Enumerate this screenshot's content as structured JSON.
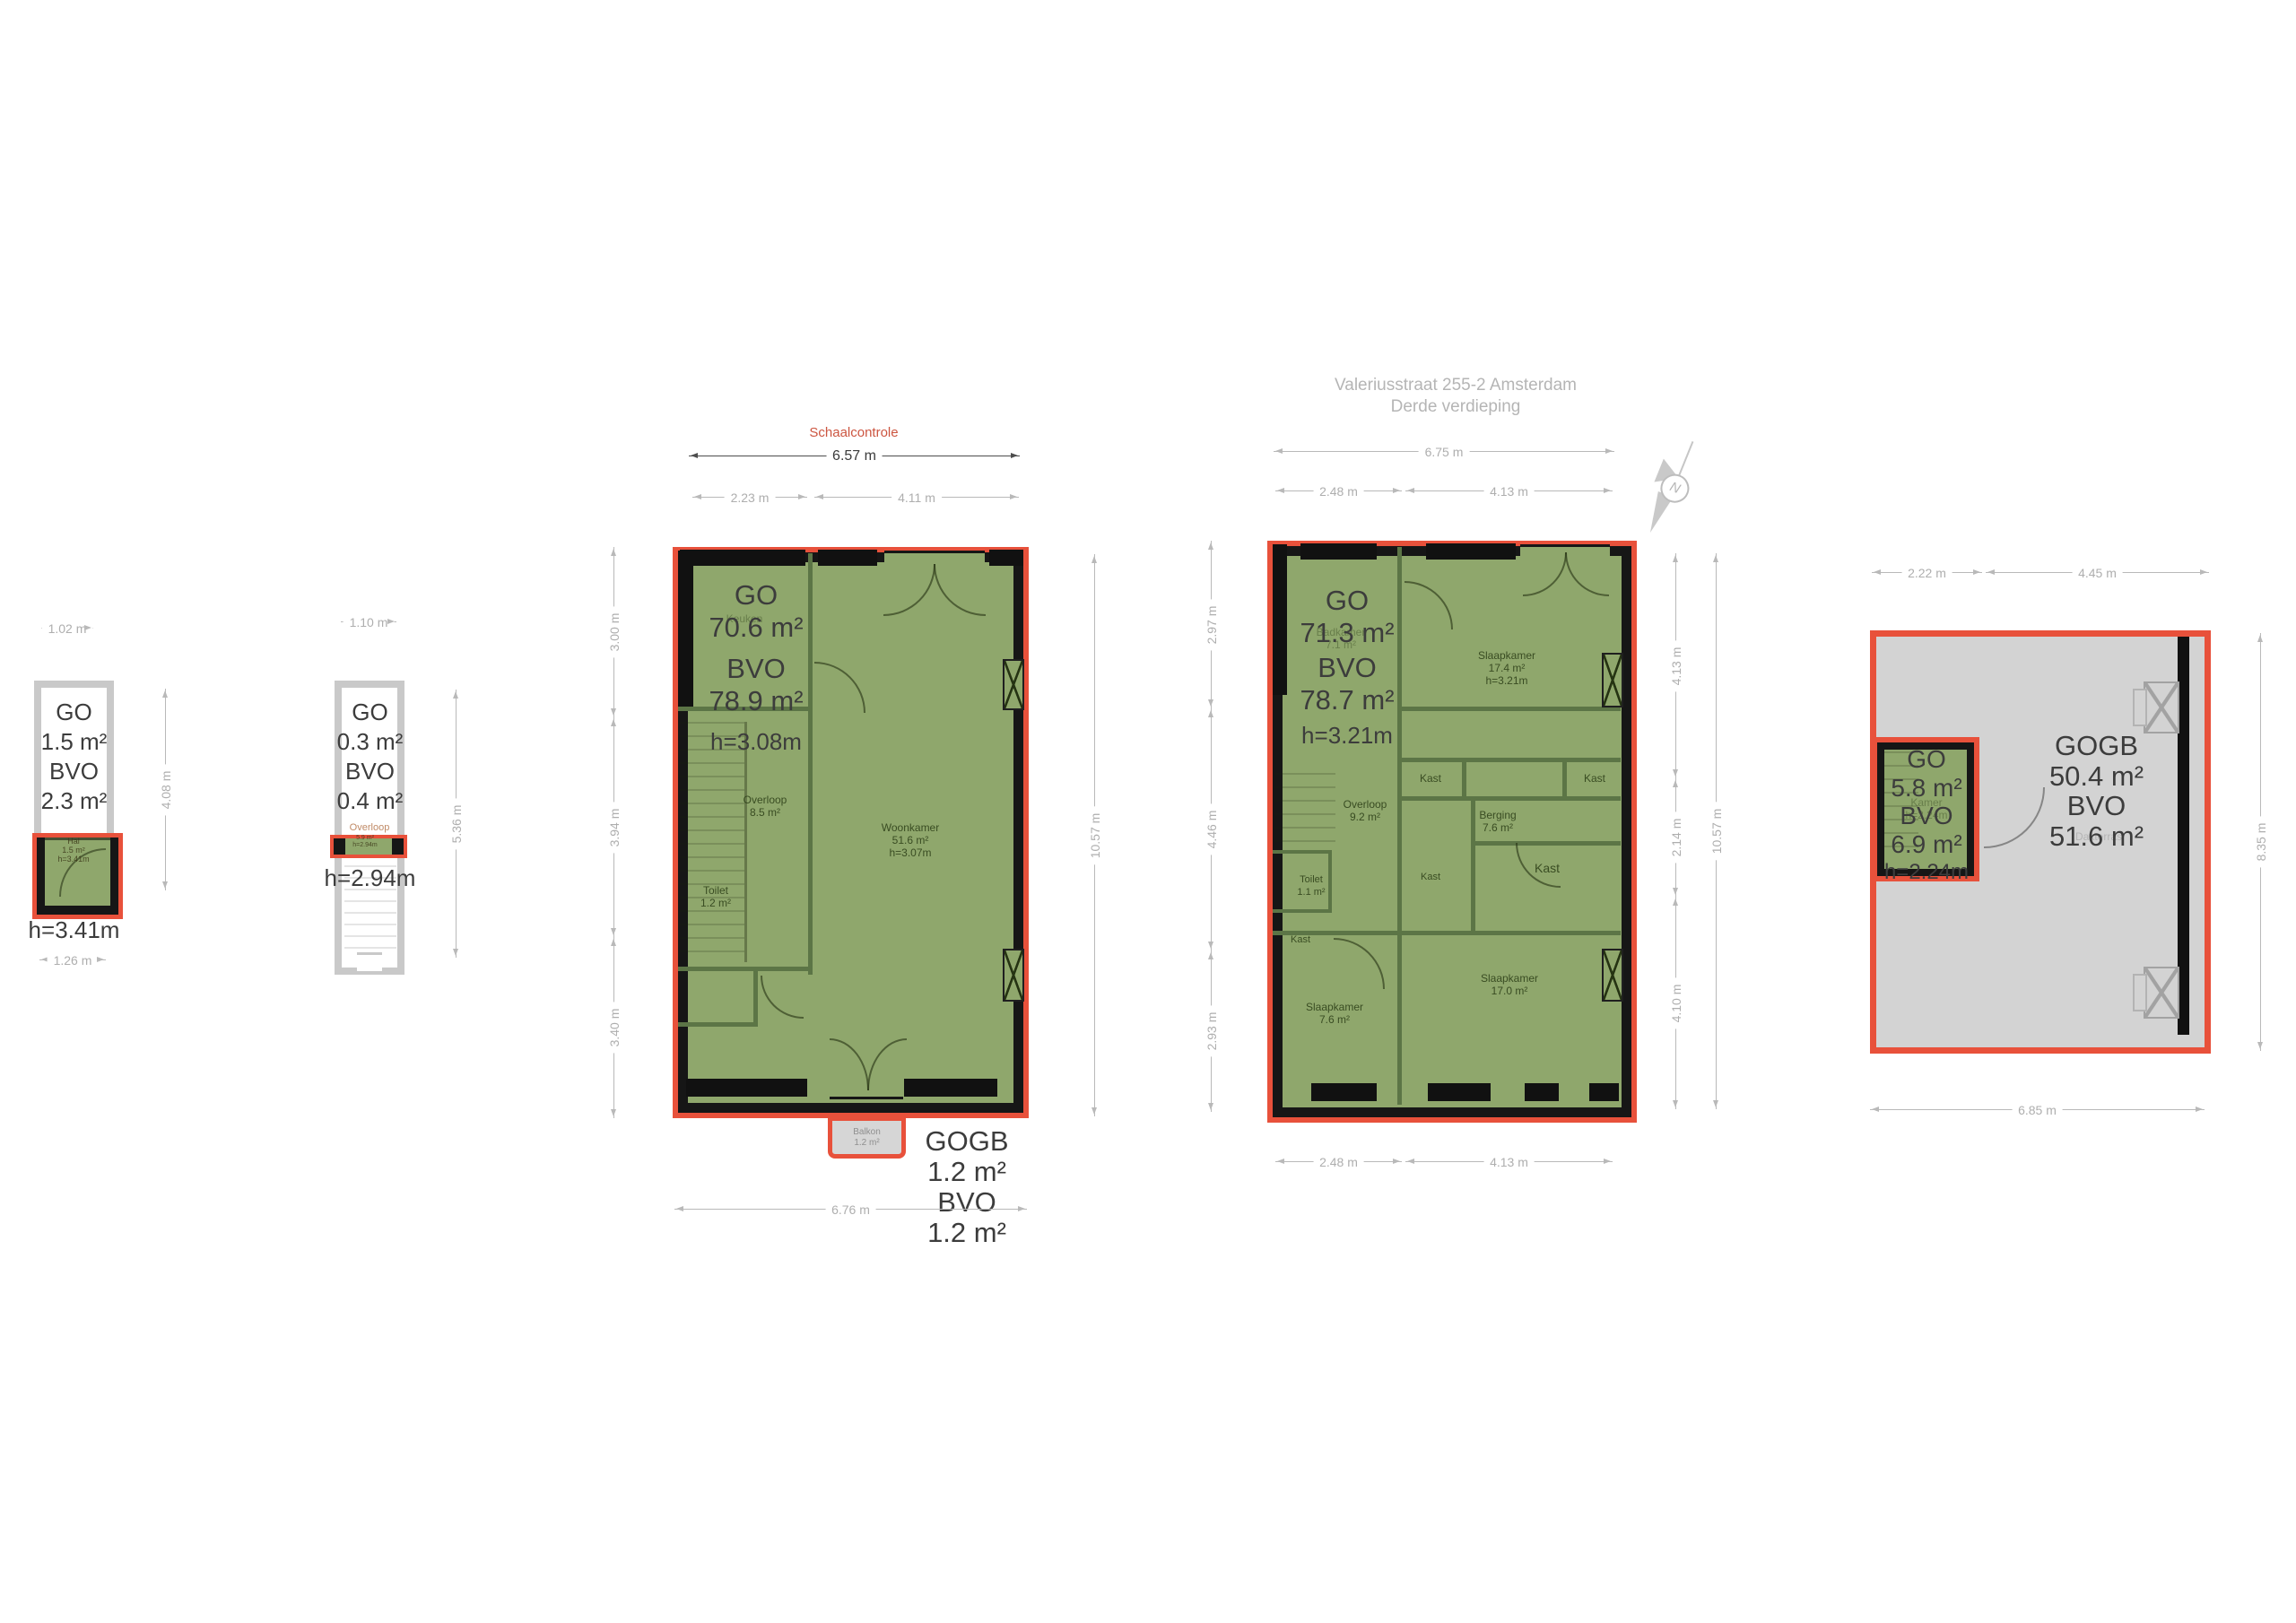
{
  "document": {
    "title_line1": "Valeriusstraat 255-2 Amsterdam",
    "title_line2": "Derde verdieping",
    "scale_control_label": "Schaalcontrole",
    "north_label": "N"
  },
  "colors": {
    "plan_green": "#8fa76c",
    "outline_red": "#e8513b",
    "wall_black": "#161616",
    "bvo_gray": "#d3d3d3",
    "dim_gray": "#aeaeae",
    "text_dark": "#3c3c3c",
    "scale_control_red": "#cc5540"
  },
  "plan_hal": {
    "go_label": "GO",
    "go_value": "1.5 m²",
    "bvo_label": "BVO",
    "bvo_value": "2.3 m²",
    "height": "h=3.41m",
    "room": {
      "name": "Hal",
      "area": "1.5 m²",
      "height": "h=3.41m"
    },
    "dim_top": "1.02 m",
    "dim_bottom": "1.26 m",
    "dim_right": "4.08 m"
  },
  "plan_overloop": {
    "go_label": "GO",
    "go_value": "0.3 m²",
    "bvo_label": "BVO",
    "bvo_value": "0.4 m²",
    "height": "h=2.94m",
    "room": {
      "name": "Overloop",
      "area": "5.9 m²",
      "height": "h=2.94m"
    },
    "dim_top": "1.10 m",
    "dim_right": "5.36 m"
  },
  "plan_tweede": {
    "scale_dim": "6.57 m",
    "dim_top_left": "2.23 m",
    "dim_top_right": "4.11 m",
    "go_label": "GO",
    "go_value": "70.6 m²",
    "bvo_label": "BVO",
    "bvo_value": "78.9 m²",
    "height": "h=3.08m",
    "rooms": {
      "keuken": {
        "name": "Keuken"
      },
      "overloop": {
        "name": "Overloop",
        "area": "8.5 m²"
      },
      "woonkamer": {
        "name": "Woonkamer",
        "area": "51.6 m²",
        "height": "h=3.07m"
      },
      "toilet": {
        "name": "Toilet",
        "area": "1.2 m²"
      }
    },
    "balkon": {
      "name": "Balkon",
      "area": "1.2 m²"
    },
    "gogb": {
      "label1": "GOGB",
      "value1": "1.2 m²",
      "label2": "BVO",
      "value2": "1.2 m²"
    },
    "dim_bottom": "6.76 m",
    "dim_left": [
      "3.00 m",
      "3.94 m",
      "3.40 m"
    ],
    "dim_right": "10.57 m"
  },
  "plan_derde": {
    "dim_top": "6.75 m",
    "dim_top_left": "2.48 m",
    "dim_top_right": "4.13 m",
    "go_label": "GO",
    "go_value": "71.3 m²",
    "bvo_label": "BVO",
    "bvo_value": "78.7 m²",
    "height": "h=3.21m",
    "rooms": {
      "badkamer": {
        "name": "Badkamer",
        "area": "7.1 m²"
      },
      "slaapkamer_top": {
        "name": "Slaapkamer",
        "area": "17.4 m²",
        "height": "h=3.21m"
      },
      "kast": "Kast",
      "overloop": {
        "name": "Overloop",
        "area": "9.2 m²"
      },
      "berging": {
        "name": "Berging",
        "area": "7.6 m²"
      },
      "toilet": {
        "name": "Toilet",
        "area": "1.1 m²"
      },
      "slaapkamer_bl": {
        "name": "Slaapkamer",
        "area": "7.6 m²"
      },
      "slaapkamer_br": {
        "name": "Slaapkamer",
        "area": "17.0 m²"
      }
    },
    "dim_bottom_left": "2.48 m",
    "dim_bottom_right": "4.13 m",
    "dim_left": [
      "2.97 m",
      "4.46 m",
      "2.93 m"
    ],
    "dim_right_segments": [
      "4.13 m",
      "2.14 m",
      "4.10 m"
    ],
    "dim_right_total": "10.57 m"
  },
  "plan_vierde": {
    "dim_top_left": "2.22 m",
    "dim_top_right": "4.45 m",
    "go_label": "GO",
    "go_value": "5.8 m²",
    "bvo_label": "BVO",
    "bvo_value": "6.9 m²",
    "height": "h=2.24m",
    "kamer": {
      "name": "Kamer",
      "height": "h=2.24m"
    },
    "gogb": {
      "label1": "GOGB",
      "value1": "50.4 m²",
      "label2": "BVO",
      "value2": "51.6 m²",
      "faint_name": "Dakterras"
    },
    "dim_bottom": "6.85 m",
    "dim_right": "8.35 m"
  }
}
